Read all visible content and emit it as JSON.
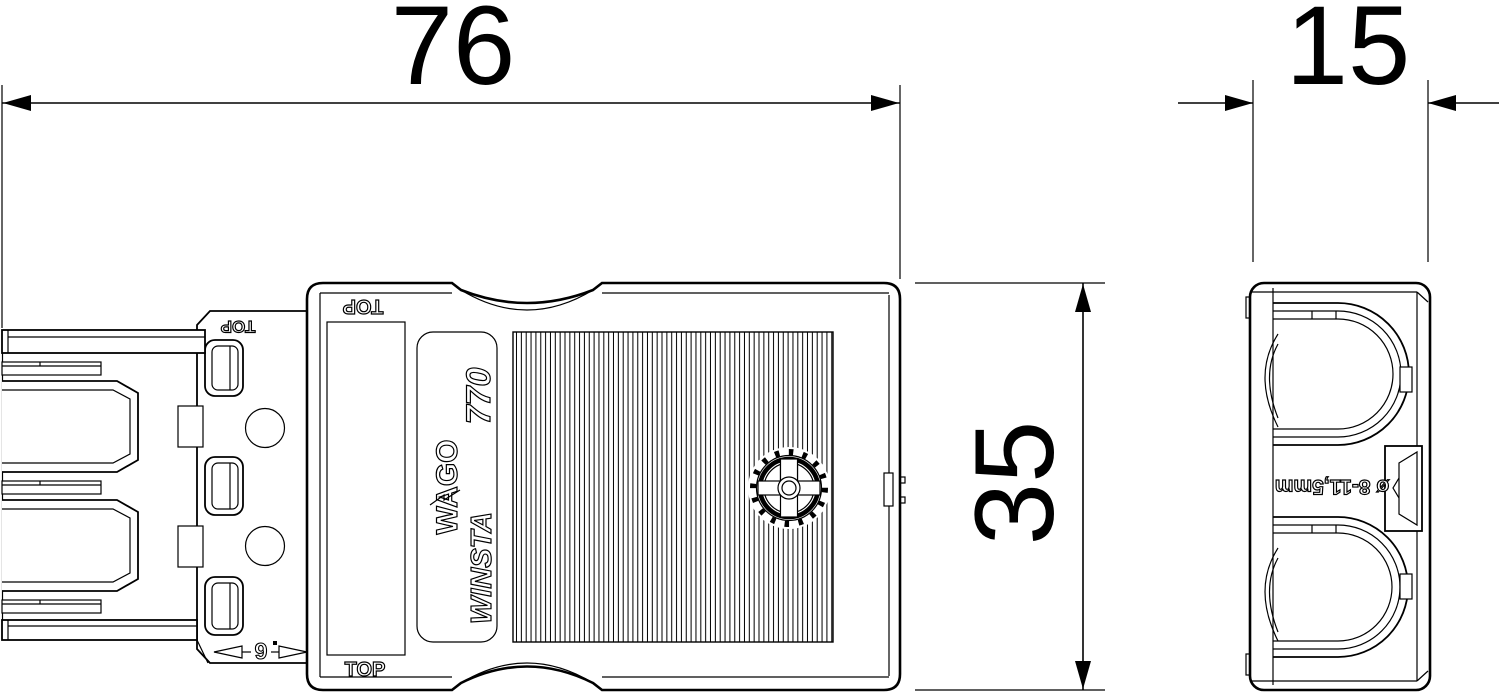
{
  "title": "WAGO WINSTA 770 connector dimensional drawing",
  "colors": {
    "line": "#000000",
    "background": "#ffffff"
  },
  "dims": {
    "width": {
      "label": "76"
    },
    "depth": {
      "label": "15"
    },
    "height": {
      "label": "35"
    },
    "engagement": {
      "label": "6"
    }
  },
  "side_view": {
    "marking_top_rotated": "TOP",
    "marking_bottom": "TOP",
    "collar_marking_rotated": "TOP",
    "nameplate": {
      "brand": "WAGO",
      "series": "770",
      "family": "WINSTA"
    }
  },
  "end_view": {
    "cable_range_rotated": "ø 8-11,5mm"
  }
}
